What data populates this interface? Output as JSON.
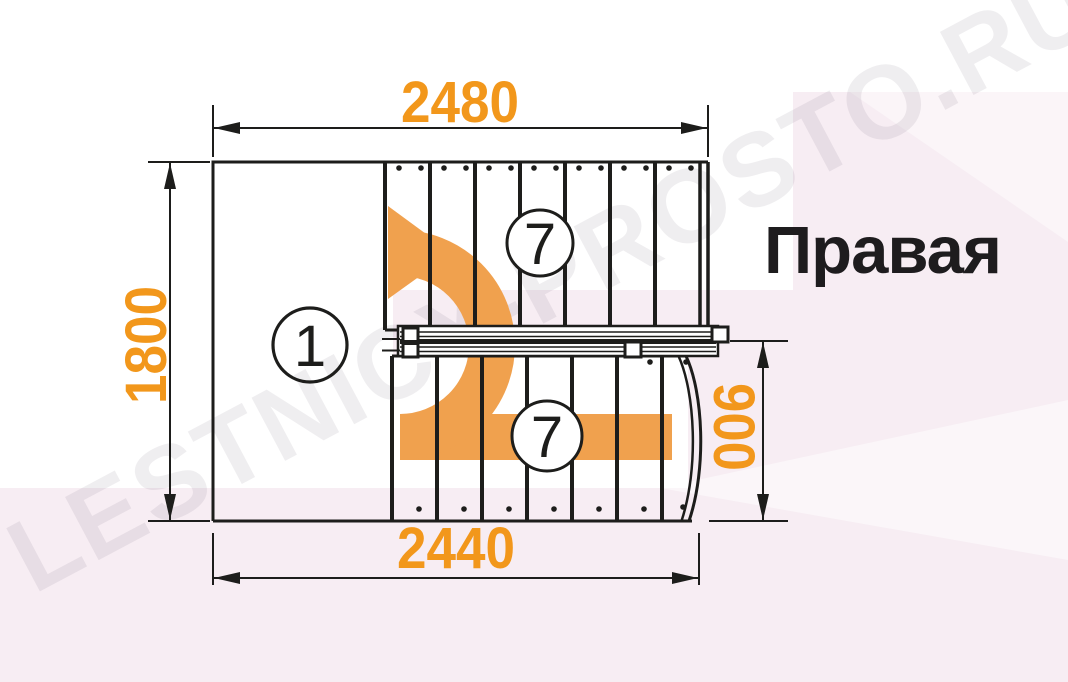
{
  "label": {
    "side": "Правая"
  },
  "watermark": {
    "text": "LESTNICY-PROSTO.RU"
  },
  "dimensions": {
    "top": "2480",
    "left": "1800",
    "right": "900",
    "bottom": "2440"
  },
  "markers": {
    "upper_flight_steps": "7",
    "lower_flight_steps": "7",
    "turn": "1"
  },
  "colors": {
    "dimension_text": "#F2971B",
    "arrow": "#F0A14E",
    "background_tint": "#F7EDF3",
    "line": "#1D1D1B"
  }
}
